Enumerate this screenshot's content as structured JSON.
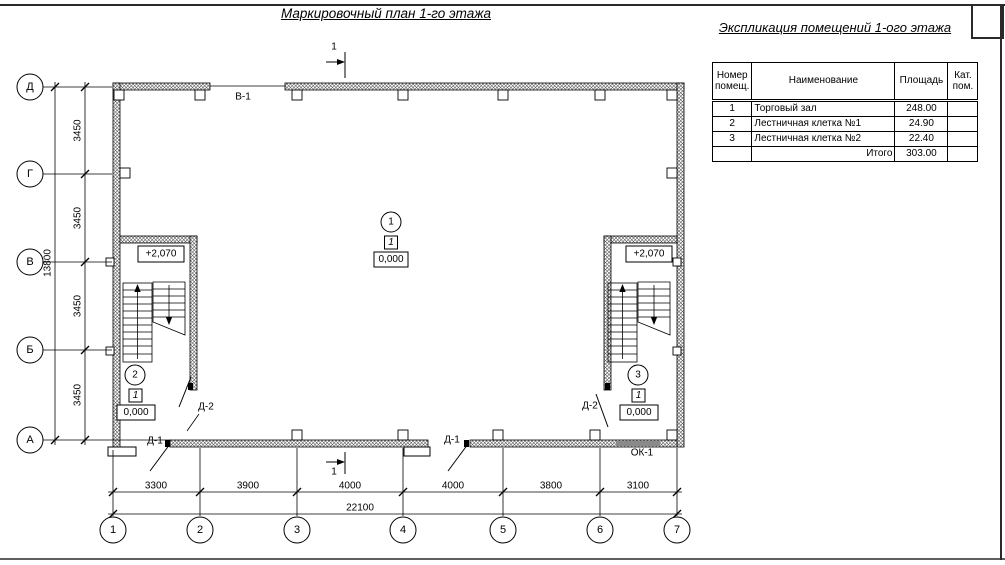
{
  "page": {
    "plan_title": "Маркировочный план 1-го этажа",
    "table_title": "Экспликация помещений 1-ого этажа"
  },
  "table": {
    "headers": [
      "Номер помещ.",
      "Наименование",
      "Площадь",
      "Кат. пом."
    ],
    "rows": [
      {
        "num": "1",
        "name": "Торговый зал",
        "area": "248.00",
        "cat": ""
      },
      {
        "num": "2",
        "name": "Лестничная клетка №1",
        "area": "24.90",
        "cat": ""
      },
      {
        "num": "3",
        "name": "Лестничная клетка №2",
        "area": "22.40",
        "cat": ""
      }
    ],
    "total_label": "Итого",
    "total_area": "303.00"
  },
  "axes": {
    "rows": [
      "Д",
      "Г",
      "В",
      "Б",
      "А"
    ],
    "cols": [
      "1",
      "2",
      "3",
      "4",
      "5",
      "6",
      "7"
    ]
  },
  "dims": {
    "left": [
      "3450",
      "3450",
      "3450",
      "3450"
    ],
    "left_total": "13800",
    "bottom": [
      "3300",
      "3900",
      "4000",
      "4000",
      "3800",
      "3100"
    ],
    "bottom_total": "22100"
  },
  "marks": {
    "section": "1",
    "gate": "В-1",
    "door1": "Д-1",
    "door2": "Д-2",
    "window": "ОК-1",
    "stair_elev": "+2,070",
    "rooms": [
      {
        "num": "1",
        "type": "1",
        "elev": "0,000"
      },
      {
        "num": "2",
        "type": "1",
        "elev": "0,000"
      },
      {
        "num": "3",
        "type": "1",
        "elev": "0,000"
      }
    ]
  }
}
